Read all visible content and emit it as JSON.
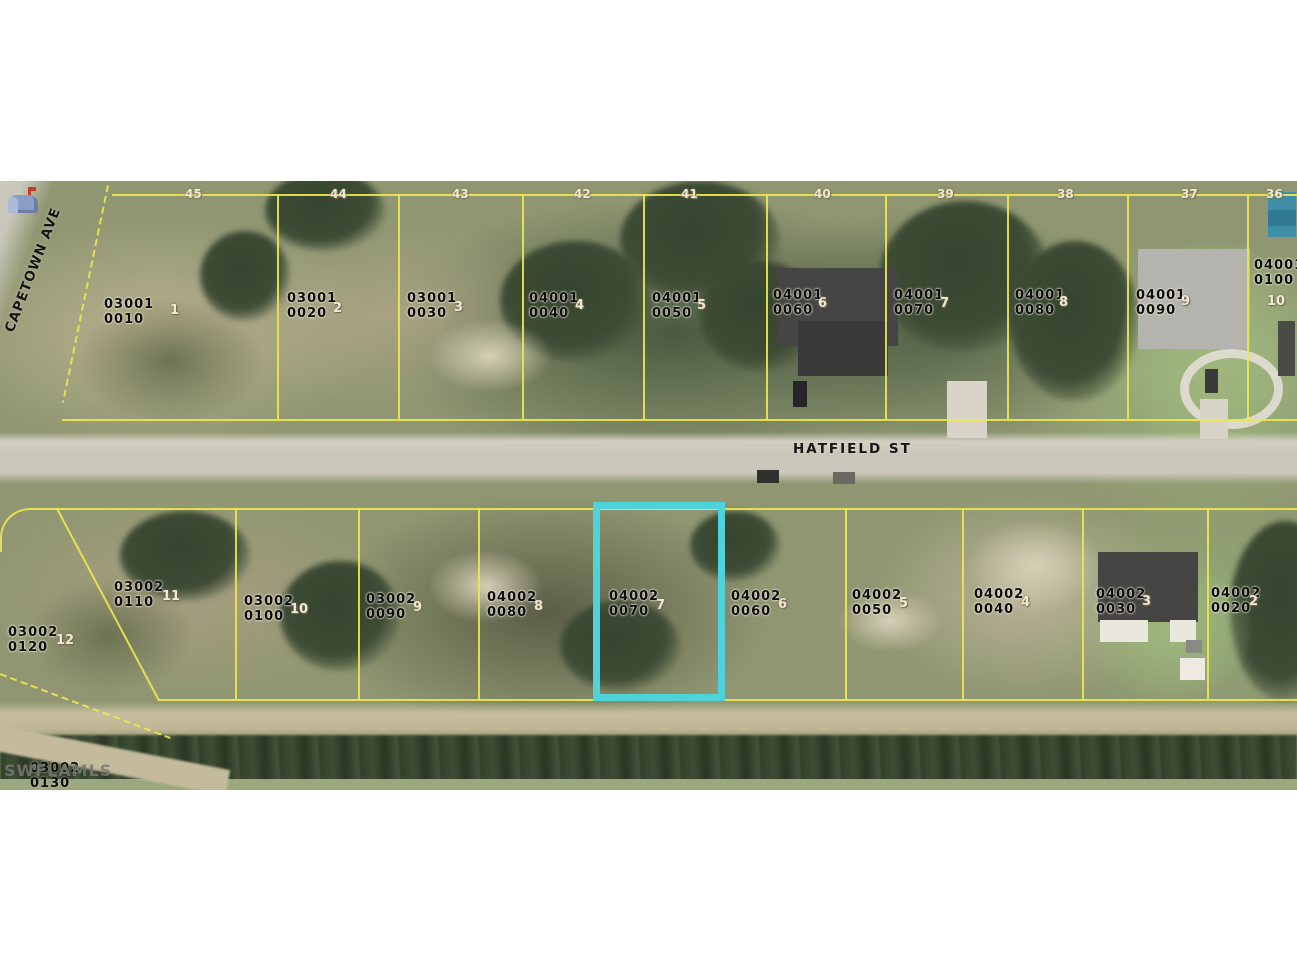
{
  "map": {
    "streets": {
      "hatfield": "HATFIELD ST",
      "capetown": "CAPETOWN AVE"
    },
    "watermark": "SWFLAMLS",
    "highlight": {
      "parcel": "04002 0070",
      "color": "#4fd3da"
    },
    "parcel_line_color": "#ece64f",
    "top_lot_numbers": [
      {
        "t": "45",
        "x": 185
      },
      {
        "t": "44",
        "x": 330
      },
      {
        "t": "43",
        "x": 452
      },
      {
        "t": "42",
        "x": 574
      },
      {
        "t": "41",
        "x": 681
      },
      {
        "t": "40",
        "x": 814
      },
      {
        "t": "39",
        "x": 937
      },
      {
        "t": "38",
        "x": 1057
      },
      {
        "t": "37",
        "x": 1181
      },
      {
        "t": "36",
        "x": 1266
      }
    ],
    "parcels_north": [
      {
        "line1": "03001",
        "line2": "0010",
        "lot": "1",
        "x": 104,
        "y": 116,
        "lx": 170,
        "ly": 122
      },
      {
        "line1": "03001",
        "line2": "0020",
        "lot": "2",
        "x": 287,
        "y": 110,
        "lx": 333,
        "ly": 120
      },
      {
        "line1": "03001",
        "line2": "0030",
        "lot": "3",
        "x": 407,
        "y": 110,
        "lx": 454,
        "ly": 119
      },
      {
        "line1": "04001",
        "line2": "0040",
        "lot": "4",
        "x": 529,
        "y": 110,
        "lx": 575,
        "ly": 117
      },
      {
        "line1": "04001",
        "line2": "0050",
        "lot": "5",
        "x": 652,
        "y": 110,
        "lx": 697,
        "ly": 117
      },
      {
        "line1": "04001",
        "line2": "0060",
        "lot": "6",
        "x": 773,
        "y": 107,
        "lx": 818,
        "ly": 115
      },
      {
        "line1": "04001",
        "line2": "0070",
        "lot": "7",
        "x": 894,
        "y": 107,
        "lx": 940,
        "ly": 115
      },
      {
        "line1": "04001",
        "line2": "0080",
        "lot": "8",
        "x": 1015,
        "y": 107,
        "lx": 1059,
        "ly": 114
      },
      {
        "line1": "04001",
        "line2": "0090",
        "lot": "9",
        "x": 1136,
        "y": 107,
        "lx": 1181,
        "ly": 113
      },
      {
        "line1": "04001",
        "line2": "0100",
        "lot": "10",
        "x": 1254,
        "y": 77,
        "lx": 1267,
        "ly": 113
      }
    ],
    "parcels_south": [
      {
        "line1": "03002",
        "line2": "0110",
        "lot": "11",
        "x": 114,
        "y": 399,
        "lx": 162,
        "ly": 408
      },
      {
        "line1": "03002",
        "line2": "0120",
        "lot": "12",
        "x": 8,
        "y": 444,
        "lx": 56,
        "ly": 452
      },
      {
        "line1": "03002",
        "line2": "0100",
        "lot": "10",
        "x": 244,
        "y": 413,
        "lx": 290,
        "ly": 421
      },
      {
        "line1": "03002",
        "line2": "0090",
        "lot": "9",
        "x": 366,
        "y": 411,
        "lx": 413,
        "ly": 419
      },
      {
        "line1": "04002",
        "line2": "0080",
        "lot": "8",
        "x": 487,
        "y": 409,
        "lx": 534,
        "ly": 418
      },
      {
        "line1": "04002",
        "line2": "0070",
        "lot": "7",
        "x": 609,
        "y": 408,
        "lx": 656,
        "ly": 417
      },
      {
        "line1": "04002",
        "line2": "0060",
        "lot": "6",
        "x": 731,
        "y": 408,
        "lx": 778,
        "ly": 416
      },
      {
        "line1": "04002",
        "line2": "0050",
        "lot": "5",
        "x": 852,
        "y": 407,
        "lx": 899,
        "ly": 415
      },
      {
        "line1": "04002",
        "line2": "0040",
        "lot": "4",
        "x": 974,
        "y": 406,
        "lx": 1021,
        "ly": 414
      },
      {
        "line1": "04002",
        "line2": "0030",
        "lot": "3",
        "x": 1096,
        "y": 406,
        "lx": 1142,
        "ly": 413
      },
      {
        "line1": "04002",
        "line2": "0020",
        "lot": "2",
        "x": 1211,
        "y": 405,
        "lx": 1249,
        "ly": 413
      }
    ],
    "cutoff_parcel": {
      "line1": "03002",
      "line2": "0130"
    }
  }
}
